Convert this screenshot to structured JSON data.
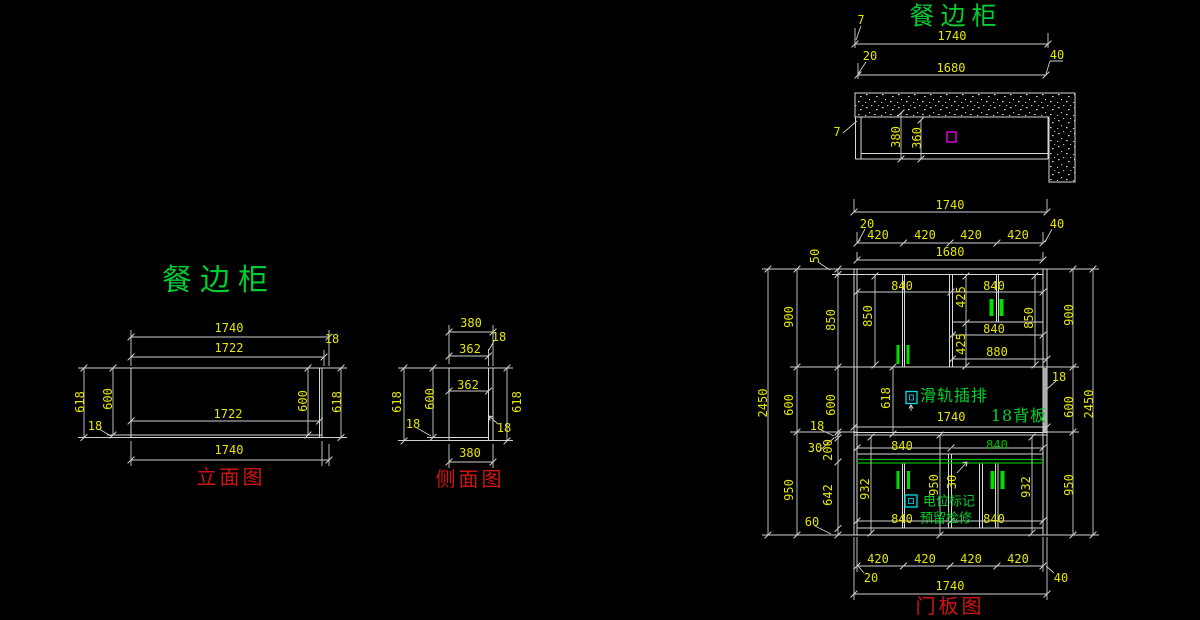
{
  "drawing": {
    "subject": "餐边柜",
    "background": "#000000",
    "colors": {
      "lines": "#d9d9d9",
      "dimension_text": "#e6e600",
      "title_green": "#00cc33",
      "caption_red": "#d01414",
      "annotation_green": "#00d22d",
      "handle_green": "#00e000",
      "shelf_line_green": "#00b400",
      "outlet_magenta": "#e800e8",
      "socket_cyan": "#00e0e8"
    }
  },
  "views": {
    "plan": {
      "caption": "餐边柜",
      "labels": [
        {
          "t": "餐边柜",
          "x": 956,
          "y": 16,
          "c": "title"
        },
        {
          "t": "7",
          "x": 861,
          "y": 20
        },
        {
          "t": "1740",
          "x": 952,
          "y": 36
        },
        {
          "t": "20",
          "x": 870,
          "y": 56
        },
        {
          "t": "40",
          "x": 1057,
          "y": 55
        },
        {
          "t": "1680",
          "x": 951,
          "y": 68
        },
        {
          "t": "7",
          "x": 837,
          "y": 132
        },
        {
          "t": "380",
          "x": 896,
          "y": 137,
          "r": 1
        },
        {
          "t": "360",
          "x": 917,
          "y": 138,
          "r": 1
        }
      ]
    },
    "elevation": {
      "caption": "立面图",
      "labels": [
        {
          "t": "餐边柜",
          "x": 219,
          "y": 281,
          "c": "title-lg"
        },
        {
          "t": "1740",
          "x": 229,
          "y": 328
        },
        {
          "t": "18",
          "x": 332,
          "y": 339
        },
        {
          "t": "1722",
          "x": 229,
          "y": 348
        },
        {
          "t": "618",
          "x": 80,
          "y": 402,
          "r": 1
        },
        {
          "t": "600",
          "x": 108,
          "y": 399,
          "r": 1
        },
        {
          "t": "18",
          "x": 95,
          "y": 426
        },
        {
          "t": "1722",
          "x": 228,
          "y": 414
        },
        {
          "t": "600",
          "x": 303,
          "y": 401,
          "r": 1
        },
        {
          "t": "618",
          "x": 337,
          "y": 402,
          "r": 1
        },
        {
          "t": "1740",
          "x": 229,
          "y": 450
        },
        {
          "t": "立面图",
          "x": 231,
          "y": 477,
          "c": "caption"
        }
      ]
    },
    "side": {
      "caption": "侧面图",
      "labels": [
        {
          "t": "380",
          "x": 471,
          "y": 323
        },
        {
          "t": "18",
          "x": 499,
          "y": 337
        },
        {
          "t": "362",
          "x": 470,
          "y": 349
        },
        {
          "t": "362",
          "x": 468,
          "y": 385
        },
        {
          "t": "618",
          "x": 397,
          "y": 402,
          "r": 1
        },
        {
          "t": "600",
          "x": 430,
          "y": 399,
          "r": 1
        },
        {
          "t": "18",
          "x": 413,
          "y": 424
        },
        {
          "t": "618",
          "x": 517,
          "y": 402,
          "r": 1
        },
        {
          "t": "18",
          "x": 504,
          "y": 428
        },
        {
          "t": "380",
          "x": 470,
          "y": 453
        },
        {
          "t": "侧面图",
          "x": 470,
          "y": 479,
          "c": "caption"
        }
      ]
    },
    "door": {
      "caption": "门板图",
      "labels": [
        {
          "t": "1740",
          "x": 950,
          "y": 205
        },
        {
          "t": "20",
          "x": 867,
          "y": 224
        },
        {
          "t": "40",
          "x": 1057,
          "y": 224
        },
        {
          "t": "420",
          "x": 878,
          "y": 235
        },
        {
          "t": "420",
          "x": 925,
          "y": 235
        },
        {
          "t": "420",
          "x": 971,
          "y": 235
        },
        {
          "t": "420",
          "x": 1018,
          "y": 235
        },
        {
          "t": "1680",
          "x": 950,
          "y": 252
        },
        {
          "t": "50",
          "x": 815,
          "y": 256,
          "r": 1
        },
        {
          "t": "900",
          "x": 789,
          "y": 317,
          "r": 1
        },
        {
          "t": "850",
          "x": 831,
          "y": 320,
          "r": 1
        },
        {
          "t": "840",
          "x": 902,
          "y": 286
        },
        {
          "t": "840",
          "x": 994,
          "y": 286
        },
        {
          "t": "425",
          "x": 961,
          "y": 297,
          "r": 1
        },
        {
          "t": "850",
          "x": 868,
          "y": 316,
          "r": 1
        },
        {
          "t": "850",
          "x": 1029,
          "y": 318,
          "r": 1
        },
        {
          "t": "840",
          "x": 994,
          "y": 329
        },
        {
          "t": "425",
          "x": 961,
          "y": 344,
          "r": 1
        },
        {
          "t": "880",
          "x": 997,
          "y": 352
        },
        {
          "t": "2450",
          "x": 763,
          "y": 403,
          "r": 1
        },
        {
          "t": "600",
          "x": 789,
          "y": 405,
          "r": 1
        },
        {
          "t": "600",
          "x": 831,
          "y": 405,
          "r": 1
        },
        {
          "t": "18",
          "x": 817,
          "y": 426
        },
        {
          "t": "30",
          "x": 815,
          "y": 448
        },
        {
          "t": "200",
          "x": 828,
          "y": 450,
          "r": 1
        },
        {
          "t": "618",
          "x": 886,
          "y": 398,
          "r": 1
        },
        {
          "t": "滑轨插排",
          "x": 954,
          "y": 396,
          "c": "note"
        },
        {
          "t": "1740",
          "x": 951,
          "y": 417
        },
        {
          "t": "18背板",
          "x": 1019,
          "y": 416,
          "c": "note"
        },
        {
          "t": "18",
          "x": 1059,
          "y": 377
        },
        {
          "t": "900",
          "x": 1069,
          "y": 315,
          "r": 1
        },
        {
          "t": "2450",
          "x": 1089,
          "y": 404,
          "r": 1
        },
        {
          "t": "600",
          "x": 1069,
          "y": 407,
          "r": 1
        },
        {
          "t": "950",
          "x": 1069,
          "y": 485,
          "r": 1
        },
        {
          "t": "950",
          "x": 789,
          "y": 490,
          "r": 1
        },
        {
          "t": "642",
          "x": 828,
          "y": 495,
          "r": 1
        },
        {
          "t": "60",
          "x": 812,
          "y": 522
        },
        {
          "t": "840",
          "x": 902,
          "y": 446
        },
        {
          "t": "840",
          "x": 997,
          "y": 445,
          "c": "note-dim"
        },
        {
          "t": "932",
          "x": 865,
          "y": 489,
          "r": 1
        },
        {
          "t": "950",
          "x": 934,
          "y": 485,
          "r": 1
        },
        {
          "t": "30",
          "x": 952,
          "y": 482,
          "r": 1
        },
        {
          "t": "932",
          "x": 1026,
          "y": 487,
          "r": 1
        },
        {
          "t": "电位标记",
          "x": 949,
          "y": 502,
          "c": "note-sm"
        },
        {
          "t": "预留检修",
          "x": 946,
          "y": 519,
          "c": "note-sm"
        },
        {
          "t": "840",
          "x": 902,
          "y": 519
        },
        {
          "t": "840",
          "x": 994,
          "y": 519
        },
        {
          "t": "420",
          "x": 878,
          "y": 559
        },
        {
          "t": "420",
          "x": 925,
          "y": 559
        },
        {
          "t": "420",
          "x": 971,
          "y": 559
        },
        {
          "t": "420",
          "x": 1018,
          "y": 559
        },
        {
          "t": "20",
          "x": 871,
          "y": 578
        },
        {
          "t": "40",
          "x": 1061,
          "y": 578
        },
        {
          "t": "1740",
          "x": 950,
          "y": 586
        },
        {
          "t": "门板图",
          "x": 950,
          "y": 606,
          "c": "caption"
        }
      ]
    }
  }
}
